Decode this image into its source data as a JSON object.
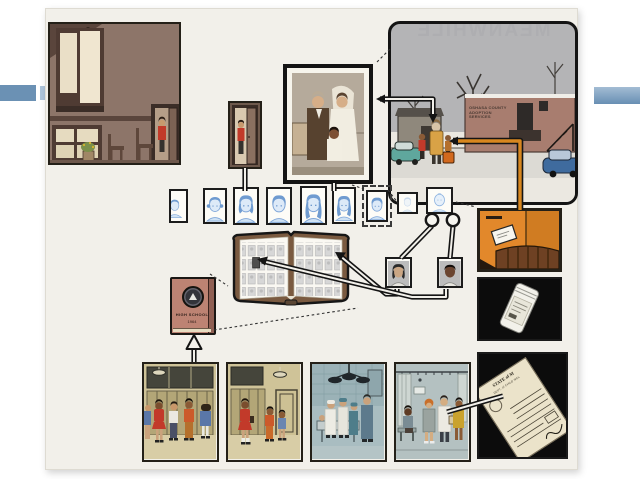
{
  "slide": {
    "background": "#ffffff",
    "accent_bars": {
      "left": "#6b91b4",
      "left_light": "#adc4da",
      "right_gradient_top": "#a3bcd4",
      "right_gradient_bottom": "#688fb3"
    }
  },
  "comic": {
    "page_background": "#f2f0ea",
    "texts": {
      "meanwhile_mirrored": "MEANWHILE",
      "adoption_sign_lines": [
        "OSHASA COUNTY",
        "ADOPTION",
        "SERVICES"
      ],
      "yearbook_cover_title": "HIGH SCHOOL",
      "yearbook_cover_year": "1964",
      "document_header": "STATE of M",
      "document_subheader": "DEPT. of CHILD WEL"
    },
    "colors": {
      "ink": "#141414",
      "room_brown": "#8d7569",
      "window_cream": "#eadfc7",
      "red_shirt": "#c23a2a",
      "sky_grey": "#b4b4b6",
      "snow": "#ebe8e1",
      "brick": "#a87d6f",
      "coat_gold": "#d9a246",
      "car_teal": "#5fa79d",
      "car_blue": "#3f6b9e",
      "portrait_blue_face": "#d6e7f7",
      "portrait_blue_hair": "#6f9bd0",
      "yearbook_salmon": "#bd8373",
      "orange_panel": "#e2882b",
      "tube_orange": "#d8871f",
      "black_panel": "#0c0c0c",
      "locker_khaki": "#b3a677",
      "clinic_blue": "#a9bdc1",
      "scrub_teal": "#4e7d8a",
      "dress_mustard": "#c9a22e",
      "document_cream": "#ebe3ca"
    }
  }
}
